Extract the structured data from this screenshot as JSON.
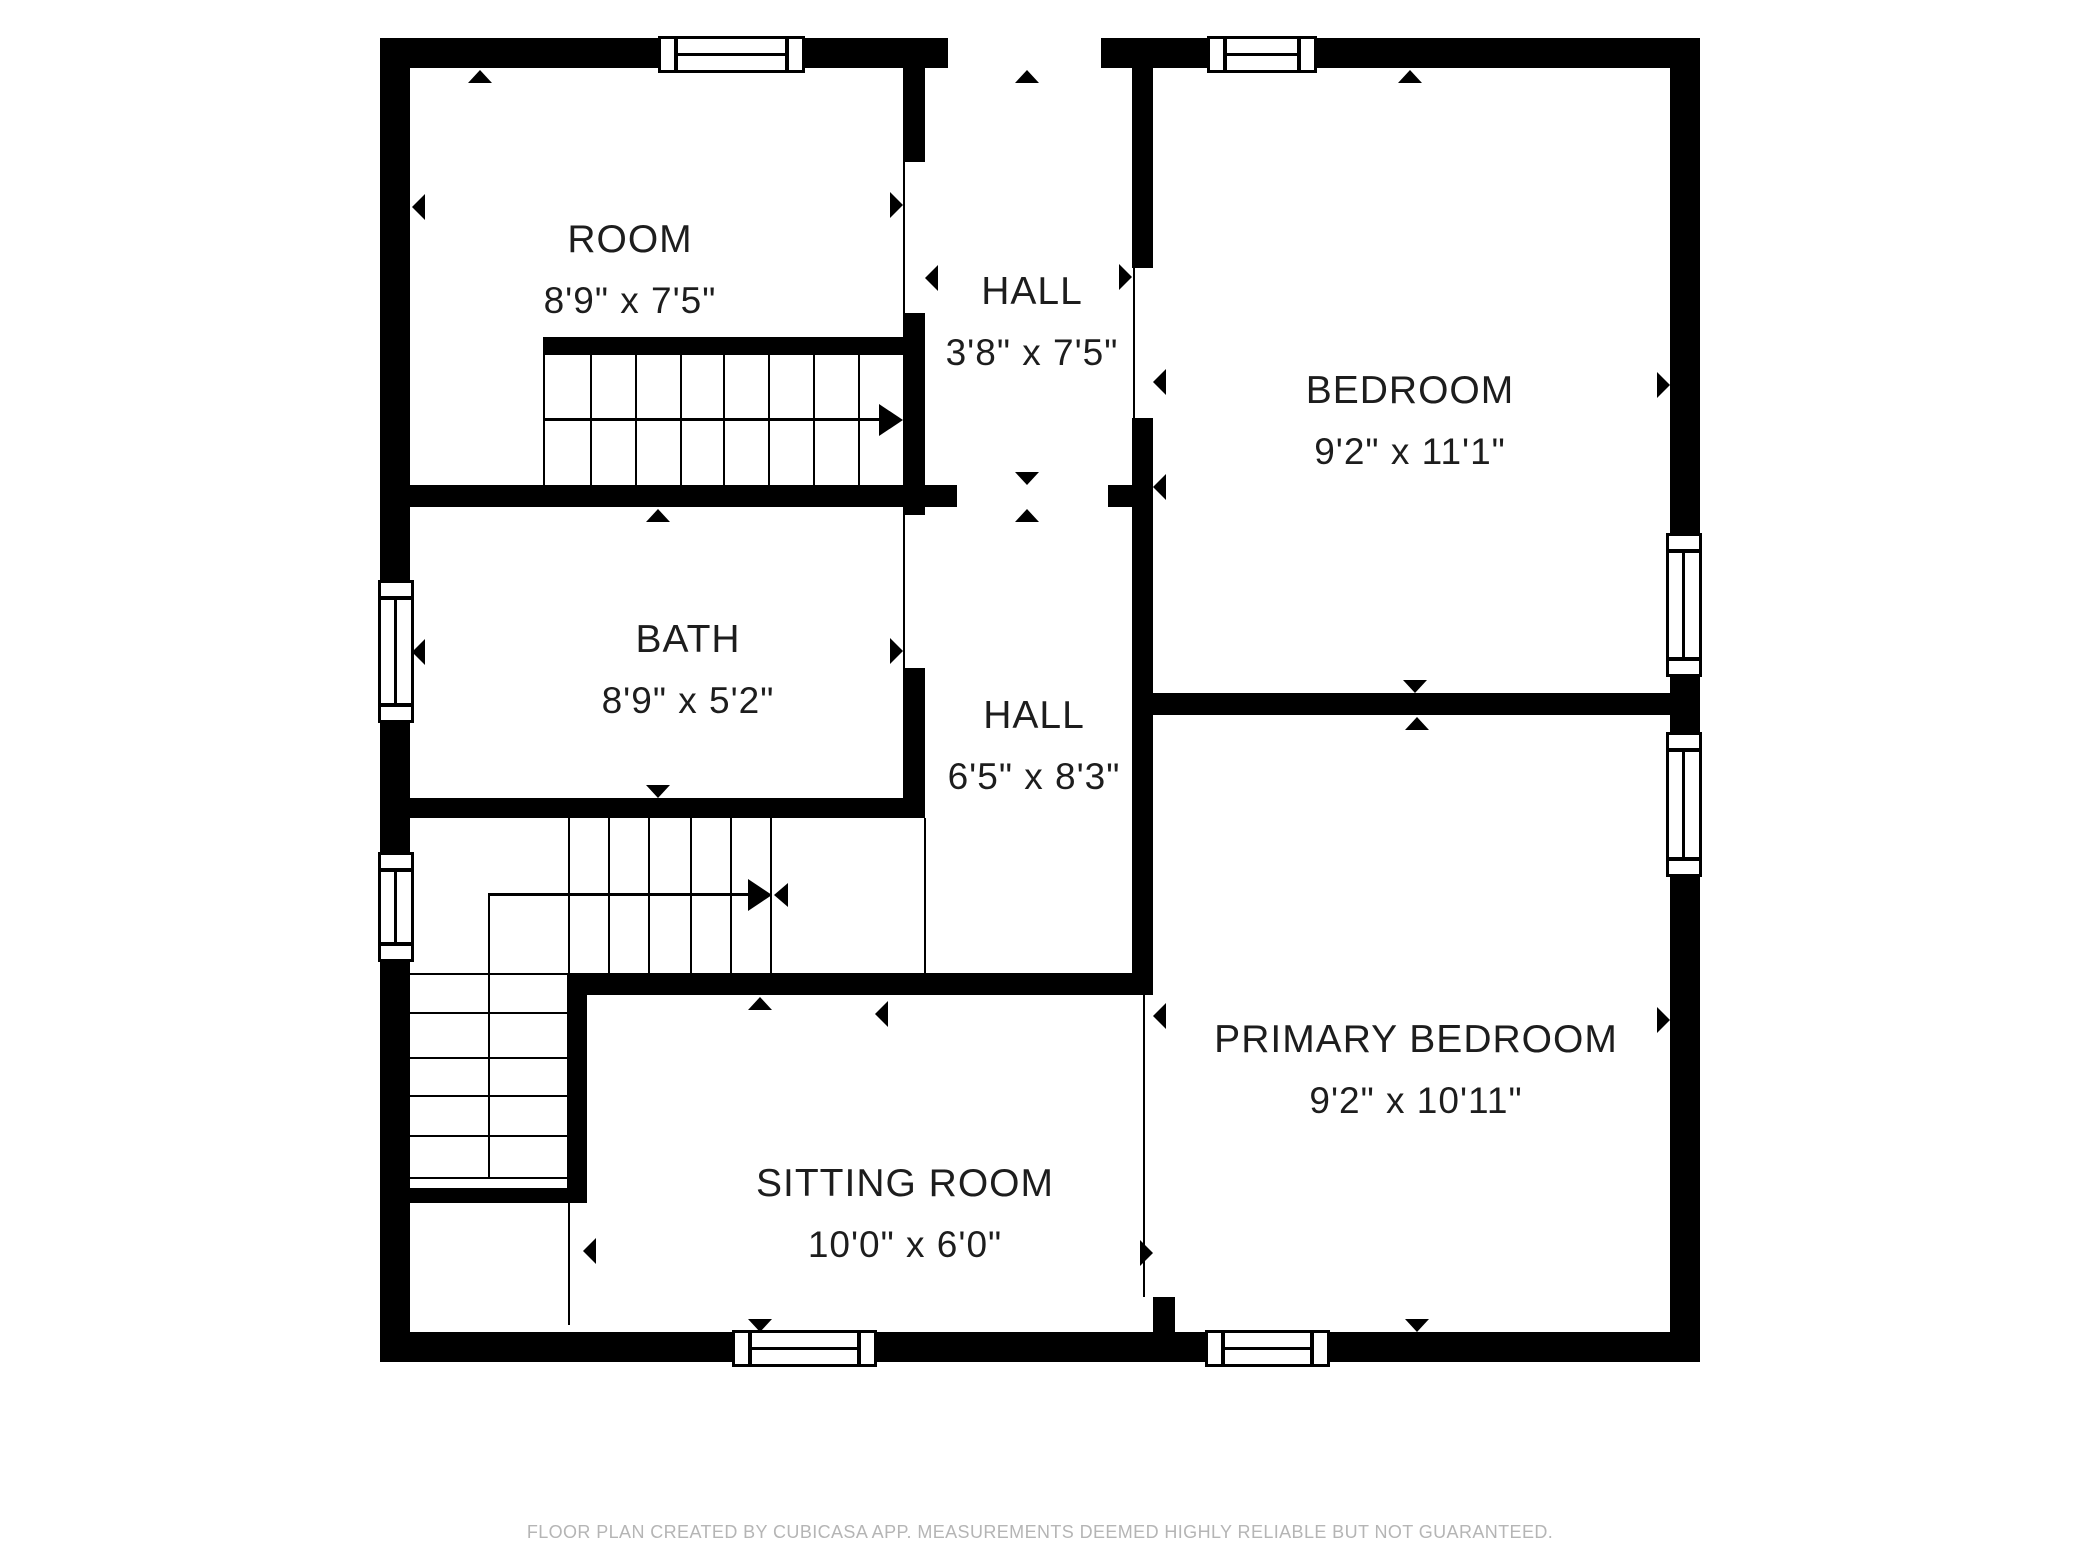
{
  "title": "Floor plan - upper floor",
  "rooms": [
    {
      "id": "room",
      "name": "ROOM",
      "dims": "8'9\" x 7'5\""
    },
    {
      "id": "hall-upper",
      "name": "HALL",
      "dims": "3'8\" x 7'5\""
    },
    {
      "id": "bedroom",
      "name": "BEDROOM",
      "dims": "9'2\" x 11'1\""
    },
    {
      "id": "bath",
      "name": "BATH",
      "dims": "8'9\" x 5'2\""
    },
    {
      "id": "hall-middle",
      "name": "HALL",
      "dims": "6'5\" x 8'3\""
    },
    {
      "id": "primary-bedroom",
      "name": "PRIMARY BEDROOM",
      "dims": "9'2\" x 10'11\""
    },
    {
      "id": "sitting-room",
      "name": "SITTING ROOM",
      "dims": "10'0\" x 6'0\""
    }
  ],
  "footer": {
    "disclaimer": "FLOOR PLAN CREATED BY CUBICASA APP. MEASUREMENTS DEEMED HIGHLY RELIABLE BUT NOT GUARANTEED."
  },
  "colors": {
    "wall": "#000000",
    "background": "#ffffff",
    "label_text": "#1d1d1d",
    "footer_text": "#b5b5b5"
  }
}
